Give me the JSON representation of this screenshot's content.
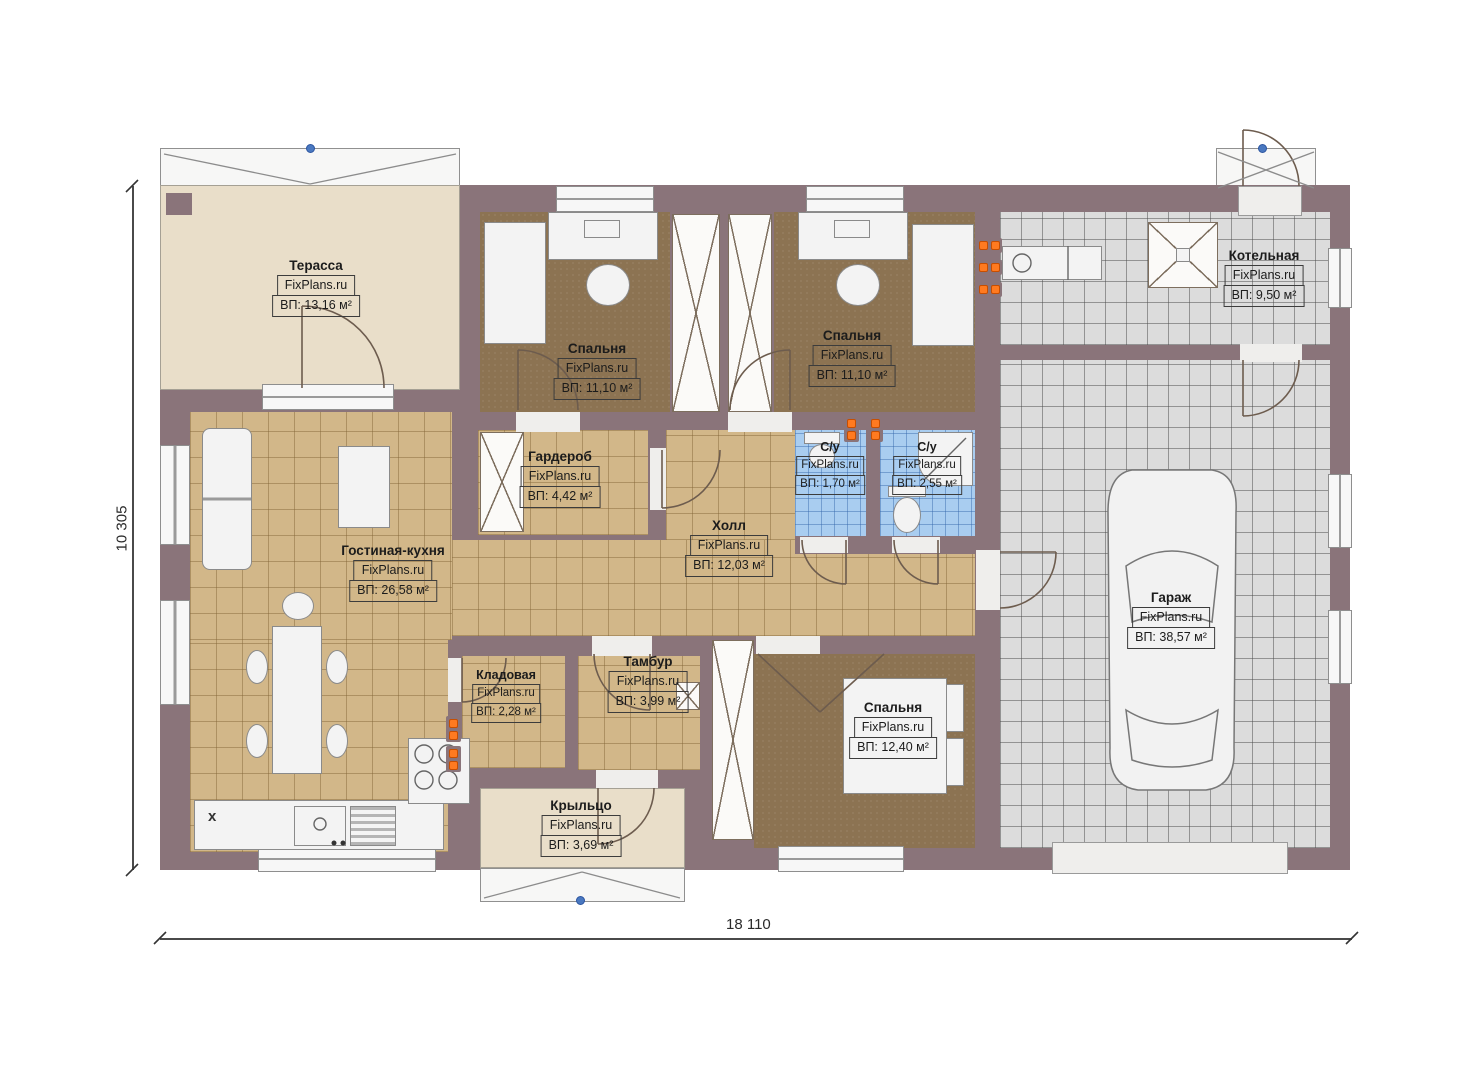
{
  "plan": {
    "brand": "FixPlans.ru",
    "rooms": [
      {
        "name": "Терасса",
        "area": "ВП: 13,16 м²"
      },
      {
        "name": "Спальня",
        "area": "ВП: 11,10 м²"
      },
      {
        "name": "Спальня",
        "area": "ВП: 11,10 м²"
      },
      {
        "name": "Котельная",
        "area": "ВП: 9,50 м²"
      },
      {
        "name": "Гардероб",
        "area": "ВП: 4,42 м²"
      },
      {
        "name": "С/у",
        "area": "ВП: 1,70 м²"
      },
      {
        "name": "С/у",
        "area": "ВП: 2,55 м²"
      },
      {
        "name": "Холл",
        "area": "ВП: 12,03 м²"
      },
      {
        "name": "Гостиная-кухня",
        "area": "ВП: 26,58 м²"
      },
      {
        "name": "Гараж",
        "area": "ВП: 38,57 м²"
      },
      {
        "name": "Кладовая",
        "area": "ВП: 2,28 м²"
      },
      {
        "name": "Тамбур",
        "area": "ВП: 3,99 м²"
      },
      {
        "name": "Спальня",
        "area": "ВП: 12,40 м²"
      },
      {
        "name": "Крыльцо",
        "area": "ВП: 3,69 м²"
      }
    ],
    "dimensions": {
      "width": "18 110",
      "height": "10 305"
    },
    "markers": {
      "fridge": "x"
    },
    "colors": {
      "wall": "#8a747a",
      "tile_tan": "#d2b789",
      "carpet_brown": "#8c7352",
      "tile_blue": "#a9cdf0",
      "tile_gray": "#dcdcdc",
      "terrace_beige": "#e9dec9",
      "radiator_orange": "#ff7a20",
      "roof_anchor_blue": "#4a78c0"
    }
  }
}
